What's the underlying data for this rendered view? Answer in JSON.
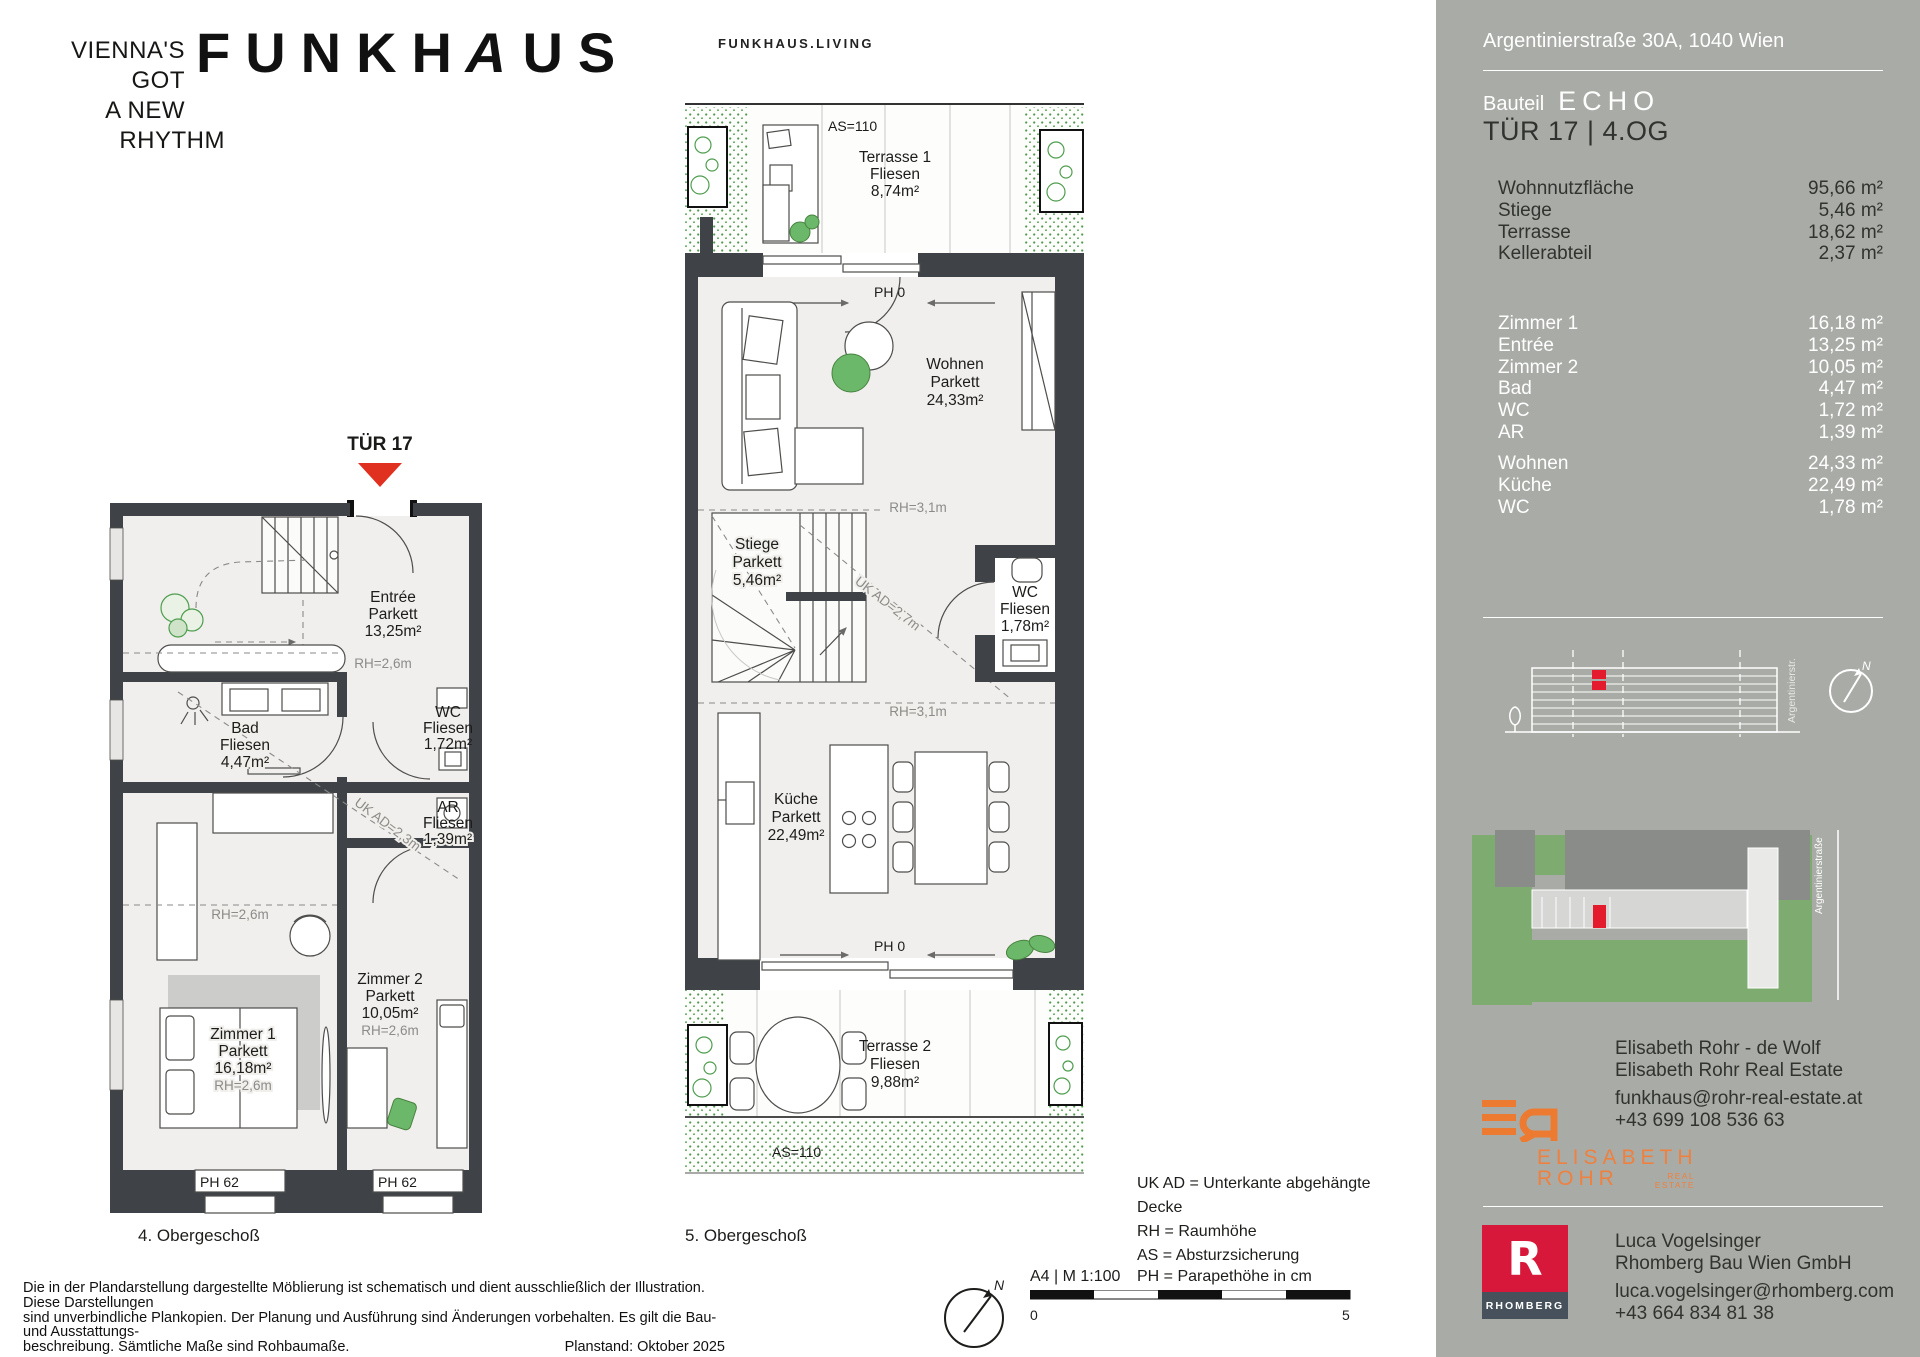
{
  "header": {
    "tagline": [
      "VIENNA'S",
      "GOT",
      "A NEW",
      "RHYTHM"
    ],
    "logo_part1": "FUNKH",
    "logo_a": "A",
    "logo_part2": "US",
    "sublogo": "FUNKHAUS.LIVING"
  },
  "plan4": {
    "door_marker": "TÜR 17",
    "caption": "4. Obergeschoß",
    "entree": [
      "Entrée",
      "Parkett",
      "13,25m²"
    ],
    "rh_entree": "RH=2,6m",
    "bad": [
      "Bad",
      "Fliesen",
      "4,47m²"
    ],
    "wc": [
      "WC",
      "Fliesen",
      "1,72m²"
    ],
    "ar": [
      "AR",
      "Fliesen",
      "1,39m²"
    ],
    "ukad": "UK AD=2,3m",
    "rh_mid": "RH=2,6m",
    "zimmer1": [
      "Zimmer 1",
      "Parkett",
      "16,18m²"
    ],
    "rh_z1": "RH=2,6m",
    "zimmer2": [
      "Zimmer 2",
      "Parkett",
      "10,05m²"
    ],
    "rh_z2": "RH=2,6m",
    "ph1": "PH 62",
    "ph2": "PH 62"
  },
  "plan5": {
    "caption": "5. Obergeschoß",
    "as1": "AS=110",
    "terrasse1": [
      "Terrasse 1",
      "Fliesen",
      "8,74m²"
    ],
    "ph_top": "PH 0",
    "wohnen": [
      "Wohnen",
      "Parkett",
      "24,33m²"
    ],
    "rh_a": "RH=3,1m",
    "stiege": [
      "Stiege",
      "Parkett",
      "5,46m²"
    ],
    "ukad": "UK AD=2,7m",
    "wc": [
      "WC",
      "Fliesen",
      "1,78m²"
    ],
    "rh_b": "RH=3,1m",
    "kueche": [
      "Küche",
      "Parkett",
      "22,49m²"
    ],
    "ph_bottom": "PH 0",
    "terrasse2": [
      "Terrasse 2",
      "Fliesen",
      "9,88m²"
    ],
    "as2": "AS=110"
  },
  "legend": {
    "line1": "UK AD = Unterkante abgehängte",
    "line2": "Decke",
    "line3": "RH = Raumhöhe",
    "line4": "AS = Absturzsicherung",
    "format": "A4 | M 1:100",
    "line5": "PH = Parapethöhe in cm",
    "scale_start": "0",
    "scale_end": "5",
    "north": "N"
  },
  "disclaimer": {
    "line1": "Die in der Plandarstellung dargestellte Möblierung ist schematisch und dient ausschließlich der Illustration. Diese Darstellungen",
    "line2": "sind unverbindliche Plankopien. Der Planung und Ausführung sind Änderungen vorbehalten. Es gilt die Bau- und Ausstattungs-",
    "line3": "beschreibung. Sämtliche Maße sind Rohbaumaße.",
    "planstand": "Planstand: Oktober 2025"
  },
  "sidebar": {
    "address": "Argentinierstraße 30A, 1040 Wien",
    "bauteil_label": "Bauteil",
    "bauteil_name": "ECHO",
    "unit": "TÜR 17  |  4.OG",
    "areas_main": [
      {
        "label": "Wohnnutzfläche",
        "value": "95,66 m²"
      },
      {
        "label": "Stiege",
        "value": "5,46 m²"
      },
      {
        "label": "Terrasse",
        "value": "18,62 m²"
      },
      {
        "label": "Kellerabteil",
        "value": "2,37 m²"
      }
    ],
    "areas_rooms": [
      {
        "label": "Zimmer 1",
        "value": "16,18 m²"
      },
      {
        "label": "Entrée",
        "value": "13,25 m²"
      },
      {
        "label": "Zimmer 2",
        "value": "10,05 m²"
      },
      {
        "label": "Bad",
        "value": "4,47 m²"
      },
      {
        "label": "WC",
        "value": "1,72 m²"
      },
      {
        "label": "AR",
        "value": "1,39 m²"
      }
    ],
    "areas_rooms2": [
      {
        "label": "Wohnen",
        "value": "24,33 m²"
      },
      {
        "label": "Küche",
        "value": "22,49 m²"
      },
      {
        "label": "WC",
        "value": "1,78 m²"
      }
    ],
    "elevation_street": "Argentinierstr.",
    "siteplan_street": "Argentinierstraße",
    "contact1_name": "Elisabeth Rohr - de Wolf",
    "contact1_company": "Elisabeth Rohr Real Estate",
    "contact1_email": "funkhaus@rohr-real-estate.at",
    "contact1_phone": "+43 699 108 536 63",
    "er_line1": "ELISABETH",
    "er_line2": "ROHR",
    "er_line3": "REAL",
    "er_line4": "ESTATE",
    "rhomberg_r": "R",
    "rhomberg_label": "RHOMBERG",
    "contact2_name": "Luca Vogelsinger",
    "contact2_company": "Rhomberg Bau Wien GmbH",
    "contact2_email": "luca.vogelsinger@rhomberg.com",
    "contact2_phone": "+43 664 834 81 38"
  }
}
